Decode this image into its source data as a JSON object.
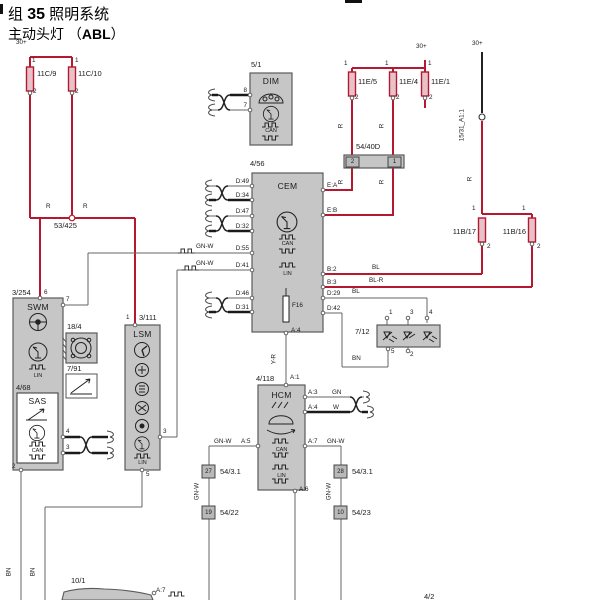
{
  "title": {
    "l1a": "组",
    "l1b": "35",
    "l1c": "照明系统",
    "l2a": "主动头灯",
    "l2b": "（",
    "l2c": "ABL",
    "l2d": "）"
  },
  "power": {
    "p30": "30+"
  },
  "pins": {
    "p1": "1",
    "p2": "2",
    "p3": "3",
    "p4": "4",
    "p5": "5",
    "p6": "6",
    "p7": "7",
    "p8": "8"
  },
  "wires": {
    "r": "R",
    "gnw": "GN-W",
    "bl": "BL",
    "blr": "BL-R",
    "bn": "BN",
    "yr": "Y-R",
    "gn": "GN",
    "w": "W"
  },
  "fuses": {
    "f11c9": "11C/9",
    "f11c10": "11C/10",
    "f11e5": "11E/5",
    "f11e4": "11E/4",
    "f11e1": "11E/1",
    "f11b17": "11B/17",
    "f11b16": "11B/16"
  },
  "refs": {
    "s53": "53/425",
    "s1531": "15/31_A1:1",
    "c5440d": "54/40D",
    "c712": "7/12",
    "c184": "18/4",
    "c791": "7/91",
    "c101": "10/1",
    "c5431": "54/3.1",
    "c5422": "54/22",
    "c5423": "54/23",
    "pin27": "27",
    "pin28": "28",
    "pin19": "19",
    "pin10": "10"
  },
  "components": {
    "dim": {
      "ref": "5/1",
      "name": "DIM",
      "bus": "CAN"
    },
    "cem": {
      "ref": "4/56",
      "name": "CEM",
      "bus1": "CAN",
      "bus2": "LIN",
      "fuse": "F16",
      "pin_bottom": "A:4",
      "pins_left": [
        "D:49",
        "D:34",
        "D:47",
        "D:32",
        "D:55",
        "D:41",
        "D:46",
        "D:31"
      ],
      "pins_right": [
        "E:A",
        "E:B",
        "B:2",
        "B:3",
        "D:29",
        "D:42"
      ]
    },
    "swm": {
      "ref": "3/254",
      "name": "SWM",
      "bus": "LIN"
    },
    "sas": {
      "ref": "4/68",
      "name": "SAS",
      "bus": "CAN"
    },
    "lsm": {
      "ref": "3/111",
      "name": "LSM",
      "bus": "LIN"
    },
    "hcm": {
      "ref": "4/118",
      "name": "HCM",
      "bus1": "CAN",
      "bus2": "LIN",
      "pins": {
        "a1": "A:1",
        "a3": "A:3",
        "a4": "A:4",
        "a5": "A:5",
        "a6": "A:6",
        "a7": "A:7"
      }
    },
    "bottom": {
      "pin": "A:7",
      "cut_ref": "4/2"
    }
  },
  "colors": {
    "power_wire": "#b5182f",
    "signal_wire": "#666666",
    "black_wire": "#1a1a1a",
    "module_fill": "#c6c6c6",
    "module_border": "#5a5a5a"
  }
}
